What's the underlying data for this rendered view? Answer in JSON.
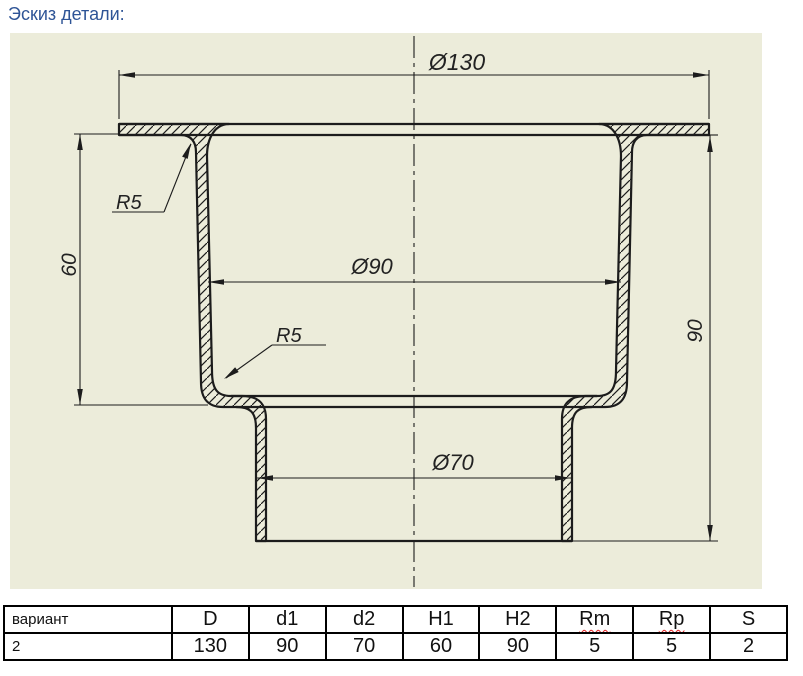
{
  "page": {
    "title": "Эскиз детали:"
  },
  "colors": {
    "title_text": "#2E5496",
    "drawing_background": "#ECECDA",
    "drawing_lines": "#1C1C1C",
    "spellcheck_underline": "#E02020"
  },
  "drawing": {
    "labels": {
      "dia_flange": "Ø130",
      "dia_cup": "Ø90",
      "dia_bottom": "Ø70",
      "height_cup": "60",
      "height_total": "90",
      "radius_top": "R5",
      "radius_bottom": "R5"
    }
  },
  "table": {
    "headers": [
      "вариант",
      "D",
      "d1",
      "d2",
      "H1",
      "H2",
      "Rm",
      "Rp",
      "S"
    ],
    "wavy_underline_headers": [
      "Rm",
      "Rp"
    ],
    "row": [
      "2",
      "130",
      "90",
      "70",
      "60",
      "90",
      "5",
      "5",
      "2"
    ]
  }
}
